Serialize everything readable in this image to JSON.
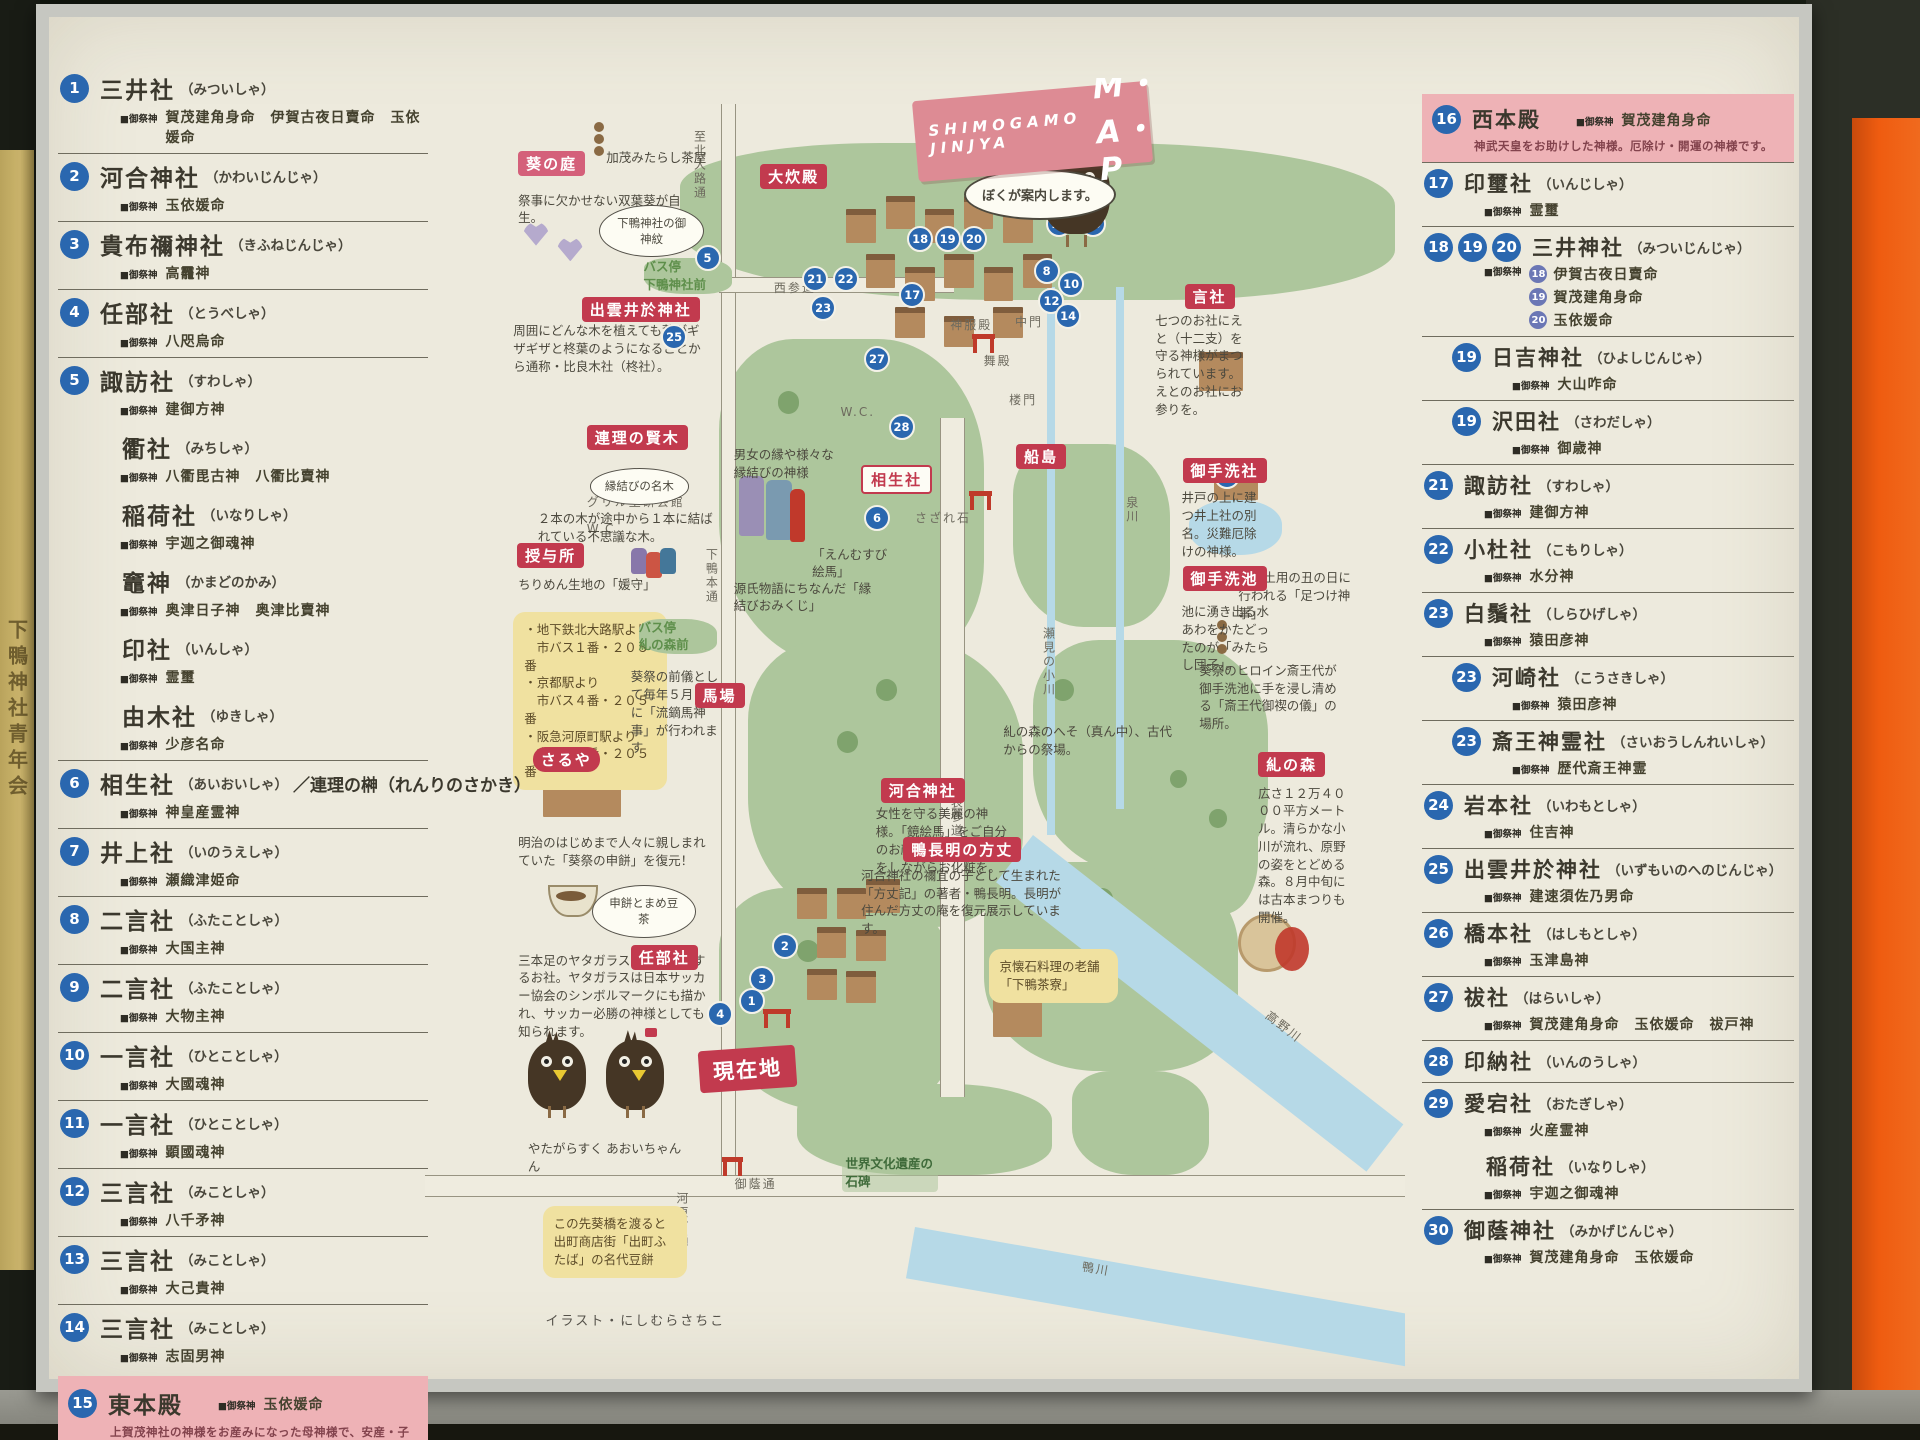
{
  "photo": {
    "side_sign_text": "下鴨神社青年会"
  },
  "labels": {
    "gosaijin": "■御祭神"
  },
  "banner": {
    "line1": "SHIMOGAMO",
    "line2": "JINJYA",
    "map_word": "M・A・P",
    "crow_bubble": "ぼくが案内します。"
  },
  "left_column": {
    "items": [
      {
        "badges": [
          "1"
        ],
        "name": "三井社",
        "reading": "（みついしゃ）",
        "deities": "賀茂建角身命　伊賀古夜日賣命　玉依媛命",
        "first": true
      },
      {
        "badges": [
          "2"
        ],
        "name": "河合神社",
        "reading": "（かわいじんじゃ）",
        "deities": "玉依媛命"
      },
      {
        "badges": [
          "3"
        ],
        "name": "貴布禰神社",
        "reading": "（きふねじんじゃ）",
        "deities": "高龗神"
      },
      {
        "badges": [
          "4"
        ],
        "name": "任部社",
        "reading": "（とうべしゃ）",
        "deities": "八咫烏命"
      },
      {
        "badges": [
          "5"
        ],
        "name": "諏訪社",
        "reading": "（すわしゃ）",
        "deities": "建御方神"
      },
      {
        "sub": true,
        "name": "衢社",
        "reading": "（みちしゃ）",
        "deities": "八衢毘古神　八衢比賣神"
      },
      {
        "sub": true,
        "name": "稲荷社",
        "reading": "（いなりしゃ）",
        "deities": "宇迦之御魂神"
      },
      {
        "sub": true,
        "name": "竈神",
        "reading": "（かまどのかみ）",
        "deities": "奥津日子神　奥津比賣神"
      },
      {
        "sub": true,
        "name": "印社",
        "reading": "（いんしゃ）",
        "deities": "霊璽"
      },
      {
        "sub": true,
        "name": "由木社",
        "reading": "（ゆきしゃ）",
        "deities": "少彦名命"
      },
      {
        "badges": [
          "6"
        ],
        "name": "相生社",
        "reading": "（あいおいしゃ）",
        "suffix": "／連理の榊（れんりのさかき）",
        "deities": "神皇産霊神"
      },
      {
        "badges": [
          "7"
        ],
        "name": "井上社",
        "reading": "（いのうえしゃ）",
        "deities": "瀬織津姫命"
      },
      {
        "badges": [
          "8"
        ],
        "name": "二言社",
        "reading": "（ふたことしゃ）",
        "deities": "大国主神"
      },
      {
        "badges": [
          "9"
        ],
        "name": "二言社",
        "reading": "（ふたことしゃ）",
        "deities": "大物主神"
      },
      {
        "badges": [
          "10"
        ],
        "name": "一言社",
        "reading": "（ひとことしゃ）",
        "deities": "大國魂神"
      },
      {
        "badges": [
          "11"
        ],
        "name": "一言社",
        "reading": "（ひとことしゃ）",
        "deities": "顕國魂神"
      },
      {
        "badges": [
          "12"
        ],
        "name": "三言社",
        "reading": "（みことしゃ）",
        "deities": "八千矛神"
      },
      {
        "badges": [
          "13"
        ],
        "name": "三言社",
        "reading": "（みことしゃ）",
        "deities": "大己貴神"
      },
      {
        "badges": [
          "14"
        ],
        "name": "三言社",
        "reading": "（みことしゃ）",
        "deities": "志固男神"
      },
      {
        "badges": [
          "15"
        ],
        "name": "東本殿",
        "highlight": true,
        "deities": "玉依媛命",
        "note": "上賀茂神社の神様をお産みになった母神様で、安産・子育ての神様です。"
      }
    ]
  },
  "right_column": {
    "items": [
      {
        "badges": [
          "16"
        ],
        "name": "西本殿",
        "highlight": true,
        "deities": "賀茂建角身命",
        "first": true,
        "note": "神武天皇をお助けした神様。厄除け・開運の神様です。"
      },
      {
        "badges": [
          "17"
        ],
        "name": "印璽社",
        "reading": "（いんじしゃ）",
        "deities": "霊璽"
      },
      {
        "badges": [
          "18",
          "19",
          "20"
        ],
        "name": "三井神社",
        "reading": "（みついじんじゃ）",
        "deity_rows": [
          {
            "n": "18",
            "d": "伊賀古夜日賣命"
          },
          {
            "n": "19",
            "d": "賀茂建角身命"
          },
          {
            "n": "20",
            "d": "玉依媛命"
          }
        ]
      },
      {
        "badges": [
          "19"
        ],
        "indent": true,
        "name": "日吉神社",
        "reading": "（ひよしじんじゃ）",
        "deities": "大山咋命"
      },
      {
        "badges": [
          "19"
        ],
        "indent": true,
        "name": "沢田社",
        "reading": "（さわだしゃ）",
        "deities": "御歳神"
      },
      {
        "badges": [
          "21"
        ],
        "name": "諏訪社",
        "reading": "（すわしゃ）",
        "deities": "建御方神"
      },
      {
        "badges": [
          "22"
        ],
        "name": "小杜社",
        "reading": "（こもりしゃ）",
        "deities": "水分神"
      },
      {
        "badges": [
          "23"
        ],
        "name": "白鬚社",
        "reading": "（しらひげしゃ）",
        "deities": "猿田彦神"
      },
      {
        "badges": [
          "23"
        ],
        "indent": true,
        "name": "河崎社",
        "reading": "（こうさきしゃ）",
        "deities": "猿田彦神"
      },
      {
        "badges": [
          "23"
        ],
        "indent": true,
        "name": "斎王神霊社",
        "reading": "（さいおうしんれいしゃ）",
        "deities": "歴代斎王神霊"
      },
      {
        "badges": [
          "24"
        ],
        "name": "岩本社",
        "reading": "（いわもとしゃ）",
        "deities": "住吉神"
      },
      {
        "badges": [
          "25"
        ],
        "name": "出雲井於神社",
        "reading": "（いずもいのへのじんじゃ）",
        "deities": "建速須佐乃男命"
      },
      {
        "badges": [
          "26"
        ],
        "name": "橋本社",
        "reading": "（はしもとしゃ）",
        "deities": "玉津島神"
      },
      {
        "badges": [
          "27"
        ],
        "name": "祓社",
        "reading": "（はらいしゃ）",
        "deities": "賀茂建角身命　玉依媛命　祓戸神"
      },
      {
        "badges": [
          "28"
        ],
        "name": "印納社",
        "reading": "（いんのうしゃ）"
      },
      {
        "badges": [
          "29"
        ],
        "name": "愛宕社",
        "reading": "（おたぎしゃ）",
        "deities": "火産霊神"
      },
      {
        "sub": true,
        "name": "稲荷社",
        "reading": "（いなりしゃ）",
        "deities": "宇迦之御魂神"
      },
      {
        "badges": [
          "30"
        ],
        "name": "御蔭神社",
        "reading": "（みかげじんじゃ）",
        "deities": "賀茂建角身命　玉依媛命"
      }
    ]
  },
  "map": {
    "red_labels": [
      {
        "text": "葵の庭",
        "x": 9.5,
        "y": 5.6,
        "variant": "pink"
      },
      {
        "text": "出雲井於神社",
        "x": 16,
        "y": 16.8
      },
      {
        "text": "連理の賢木",
        "x": 16.5,
        "y": 26.6
      },
      {
        "text": "授与所",
        "x": 9.4,
        "y": 35.6
      },
      {
        "text": "さるや",
        "x": 11,
        "y": 51.2,
        "variant": "round"
      },
      {
        "text": "任部社",
        "x": 21,
        "y": 66.4
      },
      {
        "text": "大炊殿",
        "x": 34.2,
        "y": 6.6
      },
      {
        "text": "言社",
        "x": 77.5,
        "y": 15.8
      },
      {
        "text": "相生社",
        "x": 44.5,
        "y": 29.6,
        "variant": "outline"
      },
      {
        "text": "船島",
        "x": 60.3,
        "y": 28
      },
      {
        "text": "御手洗社",
        "x": 77.3,
        "y": 29.1
      },
      {
        "text": "御手洗池",
        "x": 77.3,
        "y": 37.4
      },
      {
        "text": "糺の森",
        "x": 85,
        "y": 51.6
      },
      {
        "text": "馬場",
        "x": 27.5,
        "y": 46.3
      },
      {
        "text": "河合神社",
        "x": 46.5,
        "y": 53.6
      },
      {
        "text": "鴨長明の方丈",
        "x": 48.8,
        "y": 58.1
      },
      {
        "text": "現在地",
        "x": 28,
        "y": 74.3,
        "variant": "ribbon"
      }
    ],
    "notes": [
      {
        "text": "祭事に欠かせない双葉葵が自生。",
        "x": 9.5,
        "y": 8.7,
        "w": 17
      },
      {
        "text": "下鴨神社の御神紋",
        "x": 17.8,
        "y": 9.7,
        "w": 8,
        "cls": "bubble"
      },
      {
        "text": "加茂みたらし茶屋",
        "x": 18.5,
        "y": 5.4,
        "w": 12
      },
      {
        "text": "周囲にどんな木を植えても葉がギザギザと柊葉のようになることから通称・比良木社（柊社）。",
        "x": 9,
        "y": 18.7,
        "w": 19.5
      },
      {
        "text": "縁結びの名木",
        "x": 16.8,
        "y": 29.9,
        "w": 7.5,
        "cls": "bubble"
      },
      {
        "text": "２本の木が途中から１本に結ばれている不思議な木。",
        "x": 11.5,
        "y": 33.1,
        "w": 18
      },
      {
        "text": "ちりめん生地の「媛守」",
        "x": 9.5,
        "y": 38.1,
        "w": 15
      },
      {
        "text": "・地下鉄北大路駅より\n　市バス１番・２０５番\n・京都駅より\n　市バス４番・２０５番\n・阪急河原町駅より\n　市バス４番・２０５番",
        "x": 9,
        "y": 40.9,
        "w": 13.5,
        "cls": "yellow"
      },
      {
        "text": "バス停\n糺の森前",
        "x": 21.8,
        "y": 41.4,
        "w": 8,
        "cls": "green"
      },
      {
        "text": "バス停\n下鴨神社前",
        "x": 22.3,
        "y": 13.8,
        "w": 9,
        "cls": "green"
      },
      {
        "text": "葵祭の前儀として毎年５月３日に「流鏑馬神事」が行われます",
        "x": 21,
        "y": 45.2,
        "w": 9
      },
      {
        "text": "明治のはじめまで人々に親しまれていた「葵祭の申餅」を復元！",
        "x": 9.5,
        "y": 57.9,
        "w": 19.5
      },
      {
        "text": "申餅とまめ豆茶",
        "x": 17,
        "y": 61.8,
        "w": 8,
        "cls": "bubble"
      },
      {
        "text": "三本足のヤタガラスをおまつりするお社。ヤタガラスは日本サッカー協会のシンボルマークにも描かれ、サッカー必勝の神様としても知られます。",
        "x": 9.5,
        "y": 66.9,
        "w": 20
      },
      {
        "text": "やたがらすくん",
        "x": 10.5,
        "y": 81.3,
        "w": 8
      },
      {
        "text": "あおいちゃん",
        "x": 18.5,
        "y": 81.3,
        "w": 8
      },
      {
        "text": "男女の縁や様々な縁結びの神様",
        "x": 31.5,
        "y": 28.2,
        "w": 10.5
      },
      {
        "text": "「えんむすび絵馬」",
        "x": 39.5,
        "y": 35.8,
        "w": 8
      },
      {
        "text": "源氏物語にちなんだ「縁結びおみくじ」",
        "x": 31.5,
        "y": 38.4,
        "w": 14.5
      },
      {
        "text": "七つのお社にえと（十二支）を守る神様がまつられています。えとのお社にお参りを。",
        "x": 74.5,
        "y": 17.9,
        "w": 9.5
      },
      {
        "text": "井戸の上に建つ井上社の別名。災難厄除けの神様。",
        "x": 77.2,
        "y": 31.5,
        "w": 8
      },
      {
        "text": "夏の土用の丑の日に行われる「足つけ神事」",
        "x": 83,
        "y": 37.6,
        "w": 12
      },
      {
        "text": "池に湧き出る水あわをかたどったのが「みたらし団子」。",
        "x": 77.2,
        "y": 40.2,
        "w": 9
      },
      {
        "text": "葵祭のヒロイン斎王代が御手洗池に手を浸し清める「斎王代御禊の儀」の場所。",
        "x": 79,
        "y": 44.7,
        "w": 14.5
      },
      {
        "text": "糺の森のへそ（真ん中）、古代からの祭場。",
        "x": 59,
        "y": 49.4,
        "w": 18
      },
      {
        "text": "広さ１２万４０００平方メートル。清らかな小川が流れ、原野の姿をとどめる森。８月中旬には古本まつりも開催。",
        "x": 85,
        "y": 54.1,
        "w": 10
      },
      {
        "text": "女性を守る美麗の神様。「鏡絵馬」をご自分のお顔に見立て、願い事をしながらお化粧を。",
        "x": 46,
        "y": 55.7,
        "w": 14
      },
      {
        "text": "河合神社の禰宜の子として生まれた「方丈記」の著者・鴨長明。長明が住んだ方丈の庵を復元展示しています。",
        "x": 44.5,
        "y": 60.4,
        "w": 21
      },
      {
        "text": "京懐石料理の老舗「下鴨茶寮」",
        "x": 57.5,
        "y": 66.7,
        "w": 11,
        "cls": "yellow"
      },
      {
        "text": "この先葵橋を渡ると出町商店街「出町ふたば」の名代豆餅",
        "x": 12,
        "y": 86.4,
        "w": 12.5,
        "cls": "yellow"
      },
      {
        "text": "世界文化遺産の石碑",
        "x": 42.5,
        "y": 82.3,
        "w": 9,
        "cls": "hand-green"
      }
    ],
    "street_labels": [
      {
        "text": "至北大路通",
        "x": 27.2,
        "y": 4,
        "vert": true
      },
      {
        "text": "下鴨本通",
        "x": 28.4,
        "y": 36,
        "vert": true
      },
      {
        "text": "西参道",
        "x": 35.6,
        "y": 15.4
      },
      {
        "text": "神服殿",
        "x": 53.6,
        "y": 18.2
      },
      {
        "text": "中門",
        "x": 60.2,
        "y": 18
      },
      {
        "text": "舞殿",
        "x": 57,
        "y": 21
      },
      {
        "text": "楼門",
        "x": 59.6,
        "y": 24
      },
      {
        "text": "W.C.",
        "x": 42.4,
        "y": 25
      },
      {
        "text": "さざれ石",
        "x": 50,
        "y": 33
      },
      {
        "text": "グリル生研会館",
        "x": 16.5,
        "y": 31.8
      },
      {
        "text": "W.C.",
        "x": 16.5,
        "y": 34
      },
      {
        "text": "表参道",
        "x": 53.4,
        "y": 55,
        "vert": true
      },
      {
        "text": "瀬見の小川",
        "x": 62.8,
        "y": 42,
        "vert": true
      },
      {
        "text": "泉川",
        "x": 71.3,
        "y": 32,
        "vert": true
      },
      {
        "text": "高野川",
        "x": 85.5,
        "y": 72,
        "rot": 38
      },
      {
        "text": "鴨川",
        "x": 67,
        "y": 90.5,
        "rot": 10
      },
      {
        "text": "御蔭通",
        "x": 31.6,
        "y": 84
      },
      {
        "text": "河原町通",
        "x": 25.4,
        "y": 85.3,
        "vert": true
      }
    ],
    "badges": [
      {
        "n": "1",
        "x": 32,
        "y": 69.7
      },
      {
        "n": "2",
        "x": 35.4,
        "y": 65.5
      },
      {
        "n": "3",
        "x": 33.1,
        "y": 68
      },
      {
        "n": "4",
        "x": 28.8,
        "y": 70.7
      },
      {
        "n": "5",
        "x": 27.5,
        "y": 12.8
      },
      {
        "n": "6",
        "x": 44.8,
        "y": 32.7
      },
      {
        "n": "7",
        "x": 80.5,
        "y": 29.5
      },
      {
        "n": "8",
        "x": 62.1,
        "y": 13.8
      },
      {
        "n": "10",
        "x": 64.6,
        "y": 14.8
      },
      {
        "n": "12",
        "x": 62.6,
        "y": 16.1
      },
      {
        "n": "14",
        "x": 64.3,
        "y": 17.2
      },
      {
        "n": "15",
        "x": 63.4,
        "y": 10.2
      },
      {
        "n": "16",
        "x": 66.8,
        "y": 10.2
      },
      {
        "n": "17",
        "x": 48.4,
        "y": 15.6
      },
      {
        "n": "18",
        "x": 49.2,
        "y": 11.3
      },
      {
        "n": "19",
        "x": 52,
        "y": 11.3
      },
      {
        "n": "20",
        "x": 54.7,
        "y": 11.3
      },
      {
        "n": "21",
        "x": 38.5,
        "y": 14.4
      },
      {
        "n": "22",
        "x": 41.6,
        "y": 14.4
      },
      {
        "n": "23",
        "x": 39.3,
        "y": 16.6
      },
      {
        "n": "25",
        "x": 24.1,
        "y": 18.8
      },
      {
        "n": "27",
        "x": 44.8,
        "y": 20.5
      },
      {
        "n": "28",
        "x": 47.3,
        "y": 25.7
      }
    ],
    "credit": "イラスト・にしむらさちこ",
    "crow_captions": {
      "left": "やたがらすくん",
      "right": "あおいちゃん"
    }
  }
}
